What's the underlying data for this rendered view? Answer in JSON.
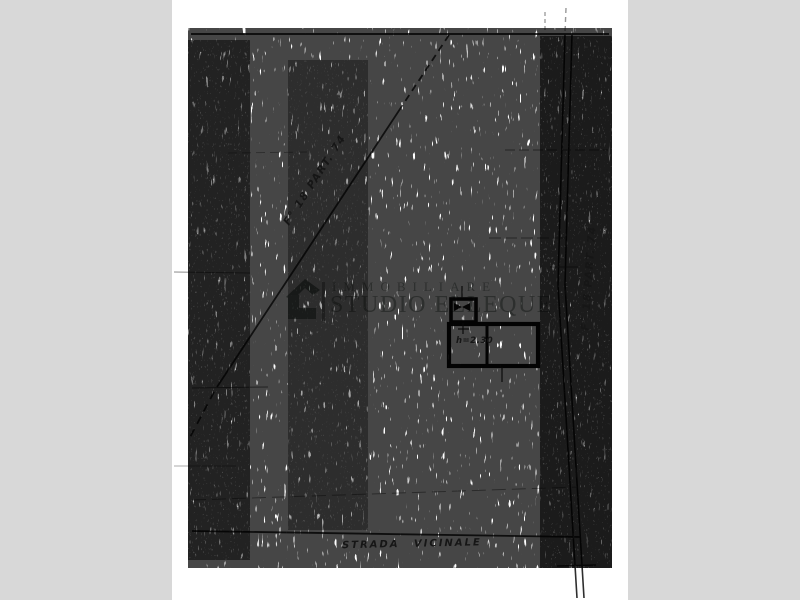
{
  "scan": {
    "paper_color": "#ffffff",
    "margin_color": "#d8d8d8",
    "ink_color": "#1a1a1a"
  },
  "watermark": {
    "line1": "IMMOBILIARE",
    "line2": "STUDIO ELLEQUE",
    "color": "#a4aba6",
    "icon": "house-logo"
  },
  "map": {
    "parcel_label_diagonal": "F° 18 PART. 74",
    "parcel_label_road": "F° 18 PART. 74",
    "road_label": "STRADA  VICINALE",
    "building_height_label": "h=2.30"
  }
}
